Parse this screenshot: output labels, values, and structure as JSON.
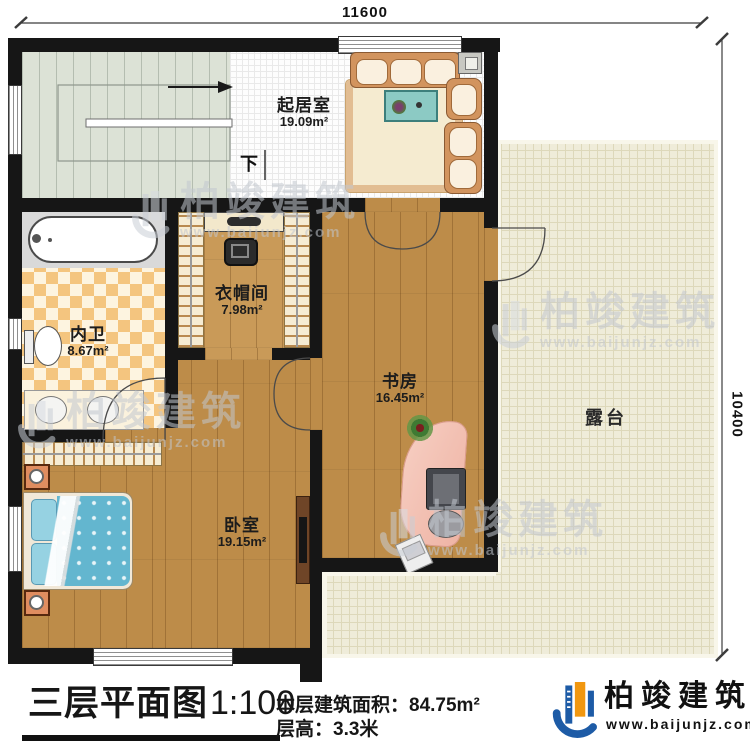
{
  "dimensions": {
    "top": "11600",
    "right": "10400"
  },
  "stairs": {
    "down": "下"
  },
  "rooms": {
    "living": {
      "name": "起居室",
      "area": "19.09m²"
    },
    "cloak": {
      "name": "衣帽间",
      "area": "7.98m²"
    },
    "bath": {
      "name": "内卫",
      "area": "8.67m²"
    },
    "study": {
      "name": "书房",
      "area": "16.45m²"
    },
    "bedroom": {
      "name": "卧室",
      "area": "19.15m²"
    },
    "terrace": {
      "name": "露台"
    }
  },
  "footer": {
    "title": "三层平面图",
    "scale": "1:100",
    "area_label": "本层建筑面积：",
    "area_value": "84.75m²",
    "floor_height_label": "层高：",
    "floor_height_value": "3.3米"
  },
  "brand": {
    "name": "柏竣建筑",
    "website": "www.baijunjz.com"
  },
  "watermark": {
    "name": "柏竣建筑",
    "website": "www.baijunjz.com"
  },
  "colors": {
    "wall": "#161616",
    "wood": "#bd8c49",
    "wood2": "#c99a58",
    "stairs": "#dce2d6",
    "terrace": "#efecd9",
    "checker1": "#f4c57f",
    "checker2": "#fdf4e0",
    "blue": "#1d5ba6",
    "orange": "#f1970f"
  }
}
